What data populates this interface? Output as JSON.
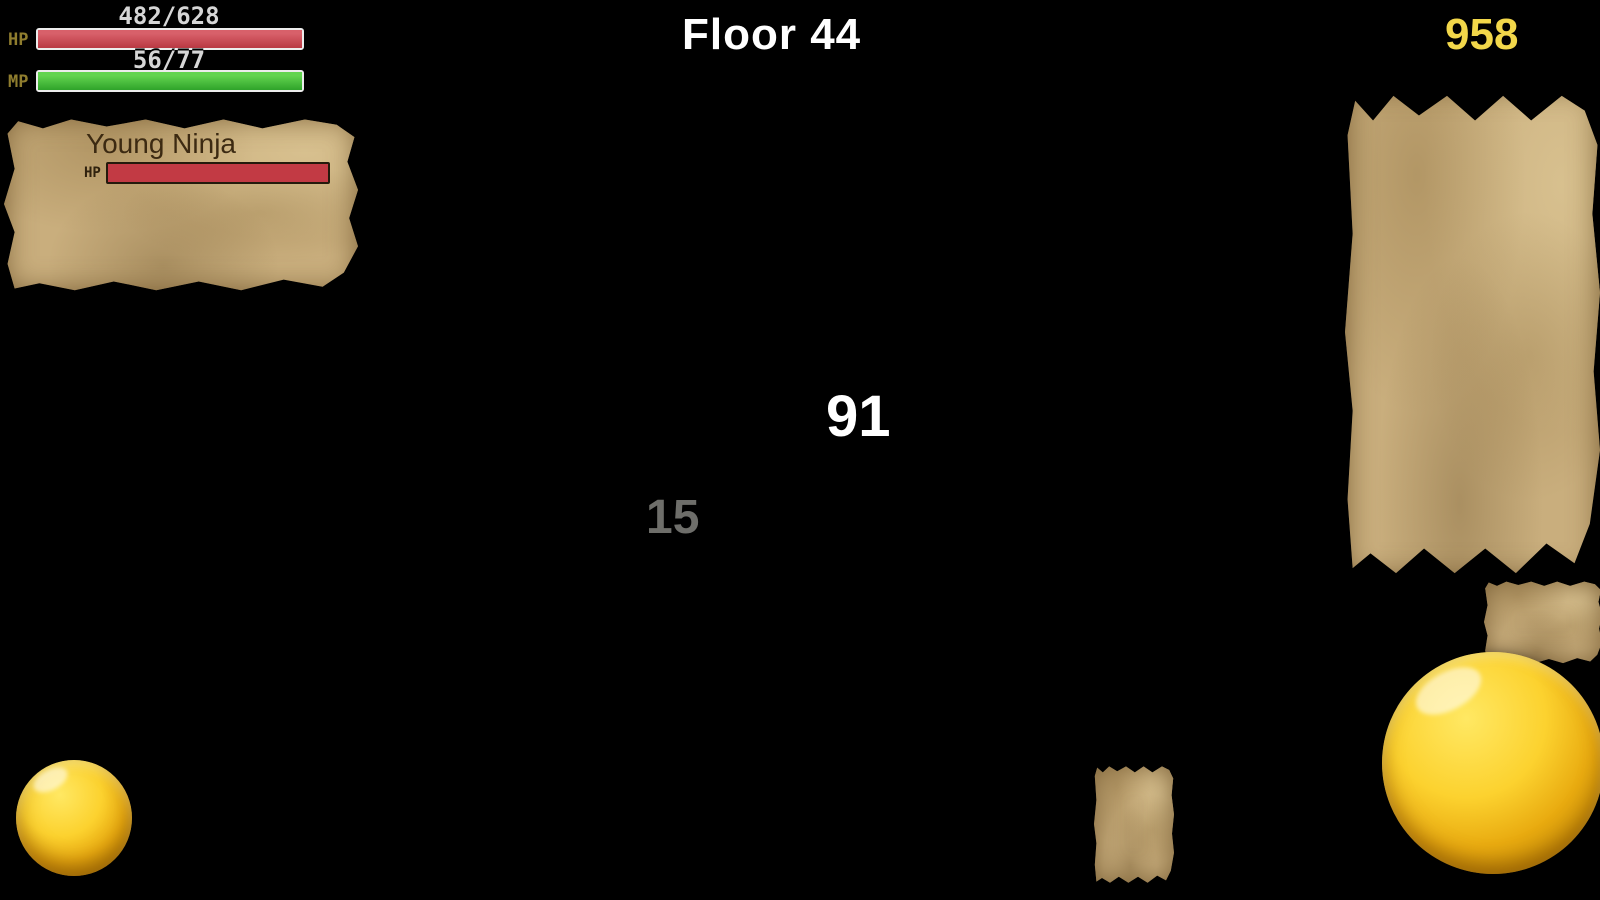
{
  "hud": {
    "hp_value": "482/628",
    "hp_label": "HP",
    "hp_pct": 77,
    "mp_value": "56/77",
    "mp_label": "MP",
    "mp_pct": 73,
    "floor_label": "Floor 44",
    "gold_value": "958"
  },
  "enemy_panel": {
    "name": "Young Ninja",
    "hp_label": "HP",
    "hp_pct": 43,
    "attack": "185",
    "stat_icons": [
      "sword",
      "shield",
      "wand",
      "boot"
    ],
    "attack_elements": [
      "fire",
      "water",
      "tree",
      "wind"
    ],
    "defense_elements": [
      "fire",
      "water",
      "tree",
      "wind"
    ]
  },
  "skill_panel": {
    "slots": [
      {
        "icon": "heart",
        "state": "disabled"
      },
      {
        "icon": "wind",
        "state": "disabled"
      },
      {
        "icon": "heart",
        "state": "ready",
        "count": "15",
        "bonus": "+100"
      },
      {
        "icon": "tree",
        "state": "ready",
        "count": "5"
      },
      {
        "icon": "fire",
        "state": "ready",
        "count": "5"
      },
      {
        "icon": "heart",
        "state": "disabled",
        "size": "large"
      },
      {
        "icon": "water",
        "state": "ready",
        "count": "5"
      }
    ]
  },
  "combat": {
    "damage": "91",
    "damage_fading": "15"
  },
  "colors": {
    "hp": "#c23a44",
    "mp": "#3fae38",
    "gold_text": "#f2d74a",
    "bonus_green": "#1e8c28",
    "parchment": "#c9ae7d"
  },
  "map": {
    "walls": [
      [
        365,
        0,
        257,
        62
      ],
      [
        744,
        0,
        601,
        62
      ],
      [
        622,
        78,
        122,
        66
      ],
      [
        365,
        62,
        150,
        86
      ],
      [
        365,
        212,
        146,
        58
      ],
      [
        365,
        270,
        146,
        140
      ],
      [
        508,
        395,
        267,
        58
      ],
      [
        607,
        453,
        243,
        112
      ],
      [
        693,
        565,
        155,
        92
      ],
      [
        850,
        318,
        126,
        92
      ],
      [
        958,
        373,
        142,
        79
      ],
      [
        1092,
        340,
        126,
        72
      ],
      [
        1196,
        215,
        122,
        88
      ],
      [
        1310,
        148,
        35,
        155
      ],
      [
        838,
        600,
        115,
        95
      ],
      [
        850,
        657,
        90,
        73
      ],
      [
        940,
        690,
        405,
        130
      ],
      [
        495,
        720,
        140,
        180
      ]
    ],
    "pits": [
      [
        622,
        0,
        122,
        78
      ],
      [
        365,
        150,
        122,
        62
      ],
      [
        512,
        268,
        88,
        50
      ],
      [
        1110,
        150,
        200,
        62
      ],
      [
        1110,
        150,
        85,
        165
      ],
      [
        875,
        272,
        88,
        48
      ],
      [
        995,
        392,
        80,
        46
      ],
      [
        740,
        500,
        90,
        63
      ],
      [
        852,
        617,
        88,
        63
      ],
      [
        518,
        745,
        95,
        155
      ],
      [
        980,
        728,
        303,
        60
      ]
    ],
    "columns": [
      {
        "x": 252,
        "w": 44,
        "dark": false
      },
      {
        "x": 1455,
        "w": 38,
        "dark": true
      },
      {
        "x": 1545,
        "w": 24,
        "dark": true
      }
    ],
    "side_strip": {
      "x": 1395,
      "w": 62
    },
    "entities": [
      {
        "name": "wall-mural",
        "type": "mural",
        "x": 376,
        "y": 56,
        "w": 134,
        "h": 90,
        "interactable": false
      },
      {
        "name": "treasure-chest",
        "type": "chest",
        "x": 398,
        "y": 326,
        "w": 84,
        "h": 102,
        "interactable": true
      },
      {
        "name": "money-bag",
        "type": "bag",
        "x": 519,
        "y": 443,
        "w": 76,
        "h": 88,
        "interactable": true
      },
      {
        "name": "money-bag",
        "type": "bag",
        "x": 1086,
        "y": 446,
        "w": 76,
        "h": 88,
        "interactable": true
      },
      {
        "name": "fin-monster",
        "type": "finmon",
        "x": 652,
        "y": 216,
        "w": 62,
        "h": 70,
        "interactable": true
      },
      {
        "name": "fin-monster",
        "type": "finmon",
        "x": 404,
        "y": 568,
        "w": 62,
        "h": 70,
        "interactable": true
      },
      {
        "name": "fin-monster",
        "type": "finmon",
        "x": 1222,
        "y": 463,
        "w": 58,
        "h": 66,
        "interactable": true
      },
      {
        "name": "fin-monster",
        "type": "finmon",
        "x": 650,
        "y": 804,
        "w": 64,
        "h": 72,
        "interactable": true
      },
      {
        "name": "fin-monster",
        "type": "finmon",
        "x": 866,
        "y": 793,
        "w": 64,
        "h": 72,
        "interactable": true
      },
      {
        "name": "dragonfly",
        "type": "dragonfly",
        "x": 506,
        "y": 548,
        "w": 98,
        "h": 54,
        "interactable": true
      },
      {
        "name": "dragonfly",
        "type": "dragonfly",
        "x": 1076,
        "y": 538,
        "w": 98,
        "h": 54,
        "interactable": true
      },
      {
        "name": "frog",
        "type": "frog",
        "x": 394,
        "y": 698,
        "w": 94,
        "h": 66,
        "interactable": true
      },
      {
        "name": "hit-ninja-enemy",
        "type": "ninjaHit",
        "x": 814,
        "y": 398,
        "w": 54,
        "h": 90,
        "interactable": true
      },
      {
        "name": "attack-slash",
        "type": "slash",
        "x": 798,
        "y": 378,
        "w": 72,
        "h": 88,
        "interactable": false
      },
      {
        "name": "player-character",
        "type": "player",
        "x": 748,
        "y": 386,
        "w": 84,
        "h": 98,
        "interactable": false
      },
      {
        "name": "walking-ninja",
        "type": "ninja",
        "x": 1438,
        "y": 784,
        "w": 54,
        "h": 94,
        "interactable": true
      }
    ]
  }
}
